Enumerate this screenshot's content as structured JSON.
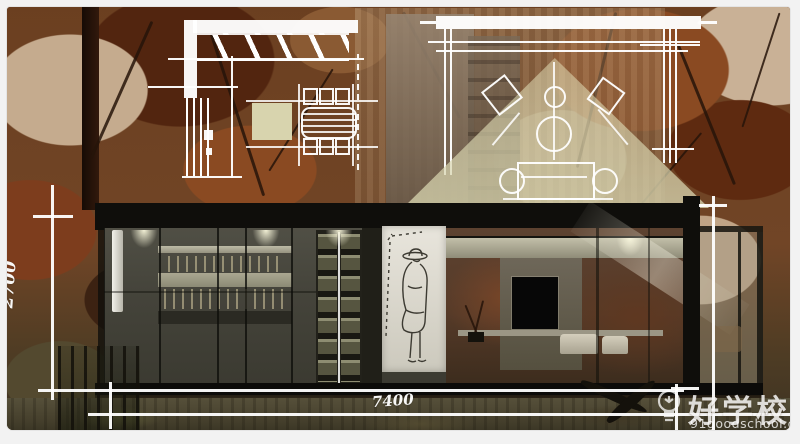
{
  "page": {
    "background": "#f2f2f2"
  },
  "artwork": {
    "type": "architectural interior section rendering with overlaid plan drawings",
    "dimensions": {
      "height_label": "2700",
      "width_label": "7400"
    }
  },
  "watermark": {
    "icon": "lightbulb-icon",
    "brand": "好学校",
    "url": "91goodschool.com"
  },
  "palette": {
    "foliage_rust": "#7a3a1c",
    "beige_patch": "#c9b196",
    "light_cone": "#ded9b4",
    "cream_block": "#d8d4ae",
    "section_gray": "#45443b",
    "drawing_lines": "#ffffff"
  }
}
